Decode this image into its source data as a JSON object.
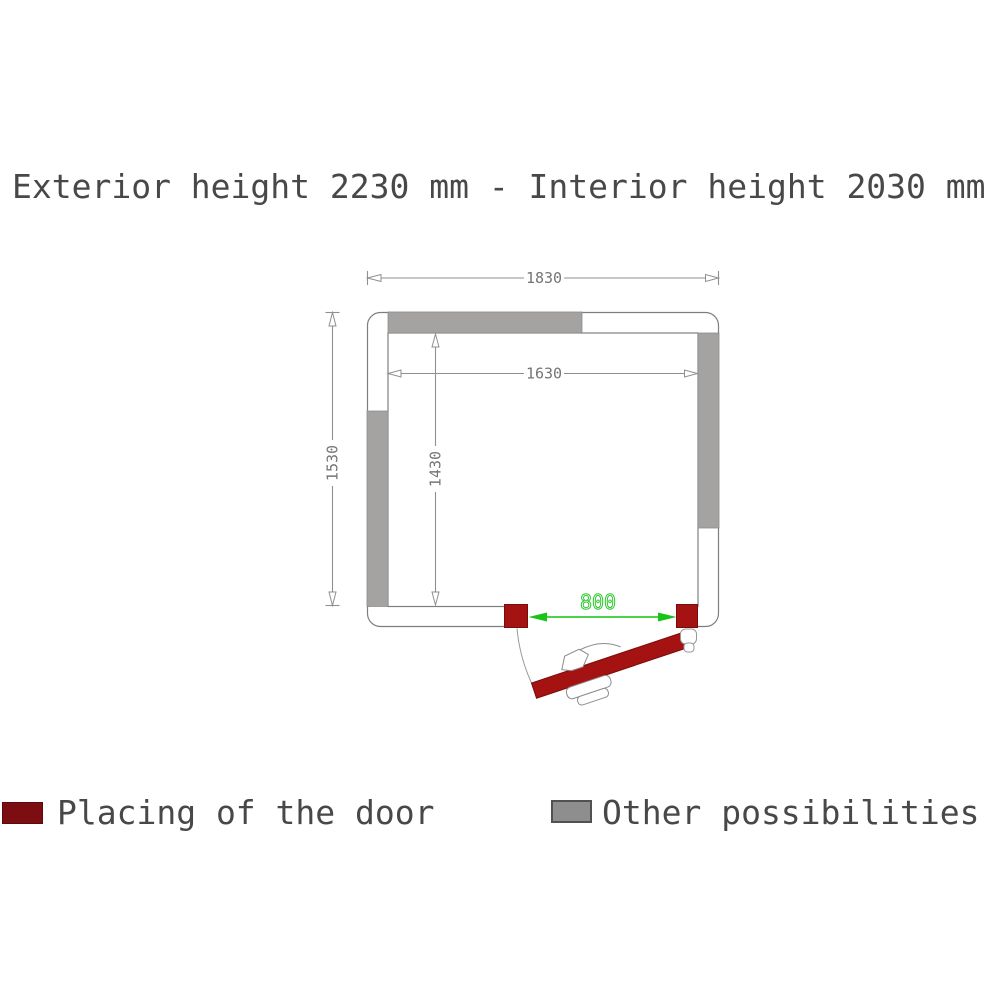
{
  "title": "Exterior height 2230 mm - Interior height 2030 mm",
  "diagram": {
    "dimensions": {
      "exterior_width_mm": "1830",
      "interior_width_mm": "1630",
      "exterior_depth_mm": "1530",
      "interior_depth_mm": "1430",
      "door_width_mm": "800"
    },
    "colors": {
      "door_red": "#a41212",
      "wall_option_gray": "#a5a2a2",
      "dimension_gray": "#8c8c8c",
      "door_dimension_green": "#2ec82e"
    }
  },
  "legend": {
    "items": [
      {
        "label": "Placing of the door",
        "swatch_color": "#7c0d10"
      },
      {
        "label": "Other possibilities",
        "swatch_color": "#8e8e8e"
      }
    ]
  }
}
